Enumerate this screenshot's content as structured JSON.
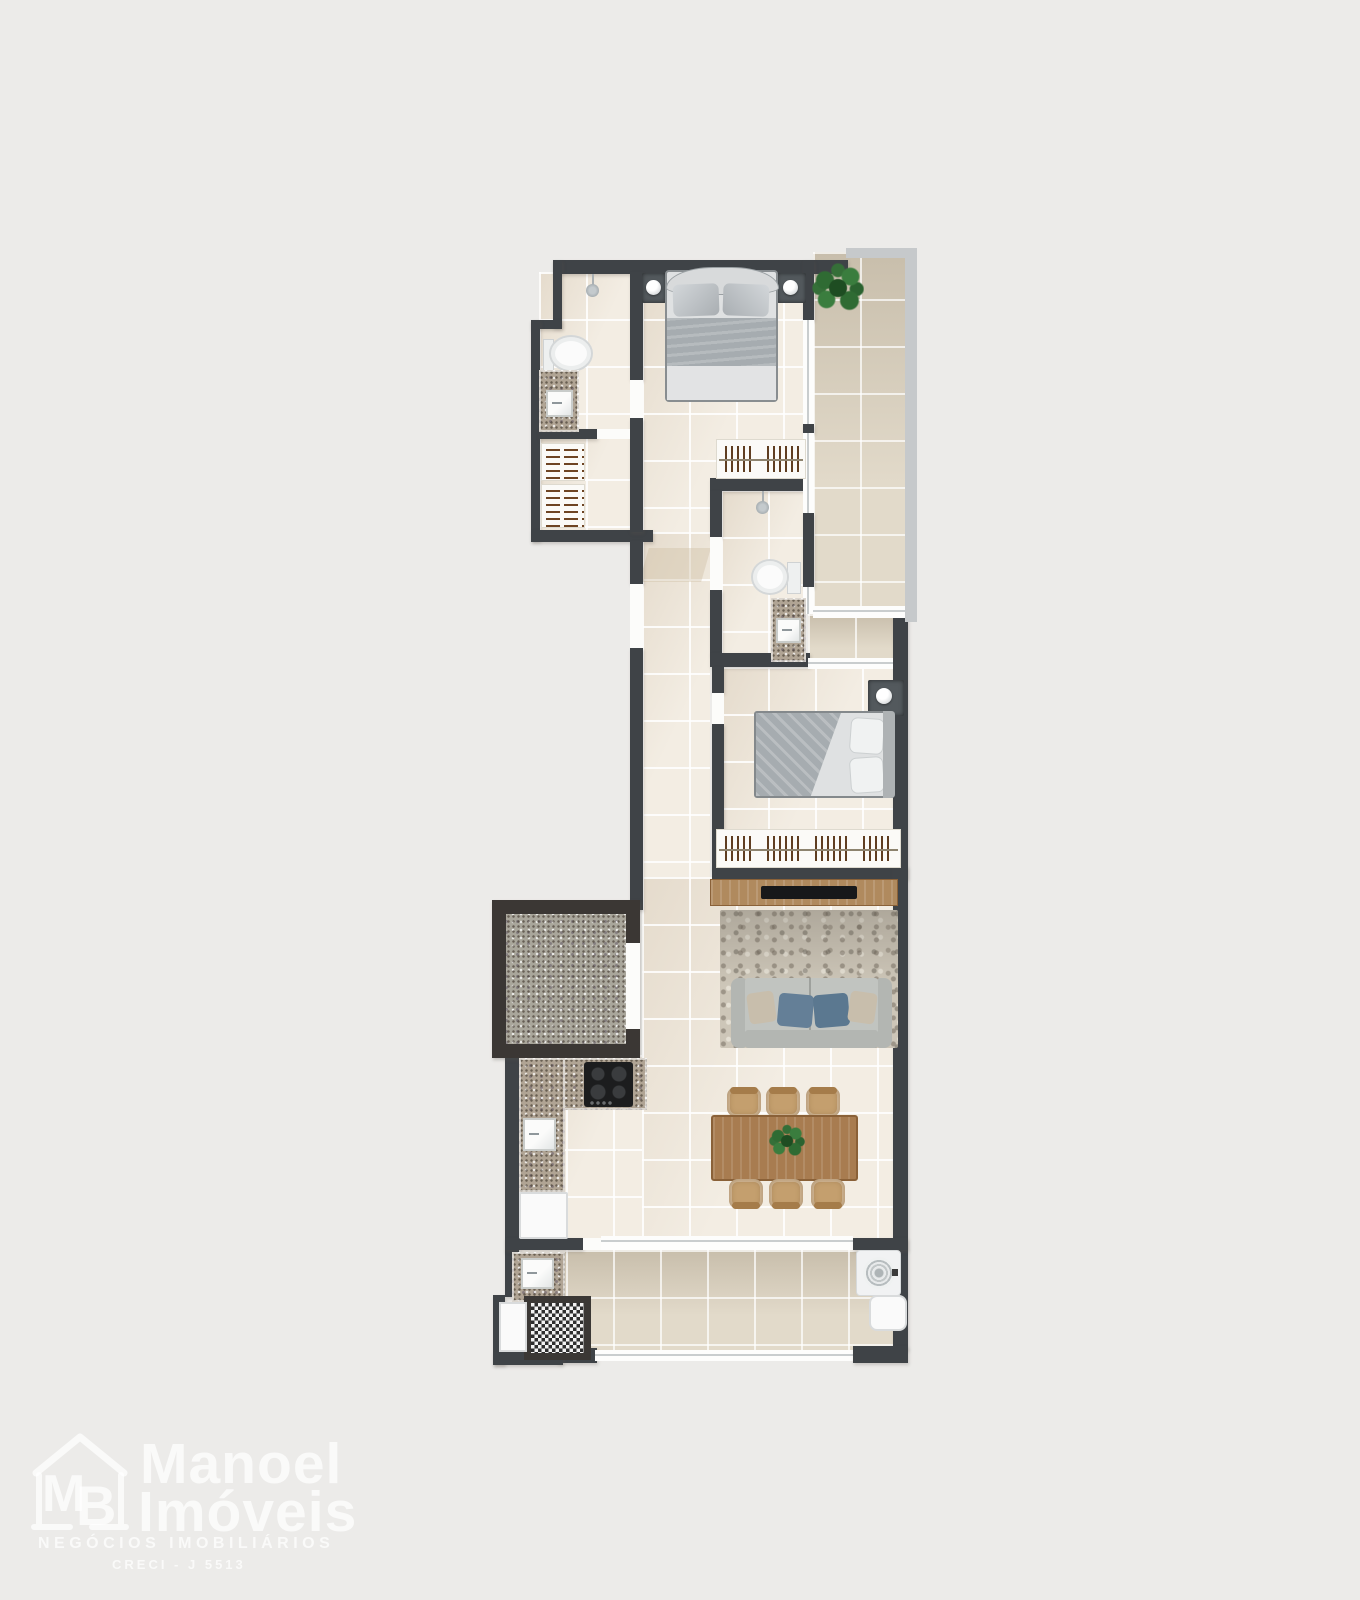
{
  "page": {
    "type": "apartment floor plan rendering (top view)",
    "background": "#ecebe9"
  },
  "watermark": {
    "initials": "MB",
    "name_line1": "Manoel",
    "name_line2": "Imóveis",
    "tagline": "NEGÓCIOS IMOBILIÁRIOS",
    "license": "CRECI - J 5513"
  },
  "palette": {
    "background": "#ecebe9",
    "wall": "#3f4347",
    "wall-light": "#c6c9cb",
    "floor-cream": "#f3ede3",
    "floor-beige": "#e2daca",
    "granite": "#b0a494",
    "wood": "#a87c50",
    "wood-light": "#c49f6e",
    "sofa": "#c1c4c0",
    "rug": "#cdc6b8",
    "bed-blanket": "#a6acb0",
    "bed-sheet": "#e2e3e4",
    "pillow-blue": "#647f97",
    "plant-green": "#2f6b33",
    "fixture-white": "#fafafa",
    "watermark": "rgba(255,255,255,0.72)"
  },
  "floorplan": {
    "rooms": [
      "suite-bedroom",
      "suite-bathroom",
      "closet",
      "hallway",
      "bathroom-2",
      "bedroom-2",
      "living-room",
      "dining-area",
      "kitchen",
      "elevator-shaft",
      "balcony",
      "service-area"
    ],
    "furniture_and_fixtures": [
      "double-bed",
      "two-nightstands-with-lamps",
      "toilets",
      "vanity-sinks",
      "showers",
      "clothes-racks",
      "single-bed",
      "tv-console",
      "tv",
      "sofa-with-pillows",
      "area-rug",
      "dining-table-with-six-chairs",
      "potted-plants",
      "cooktop",
      "kitchen-sink",
      "refrigerator",
      "service-sink",
      "utility-shaft-grate",
      "washing-machine",
      "laundry-tank"
    ]
  }
}
